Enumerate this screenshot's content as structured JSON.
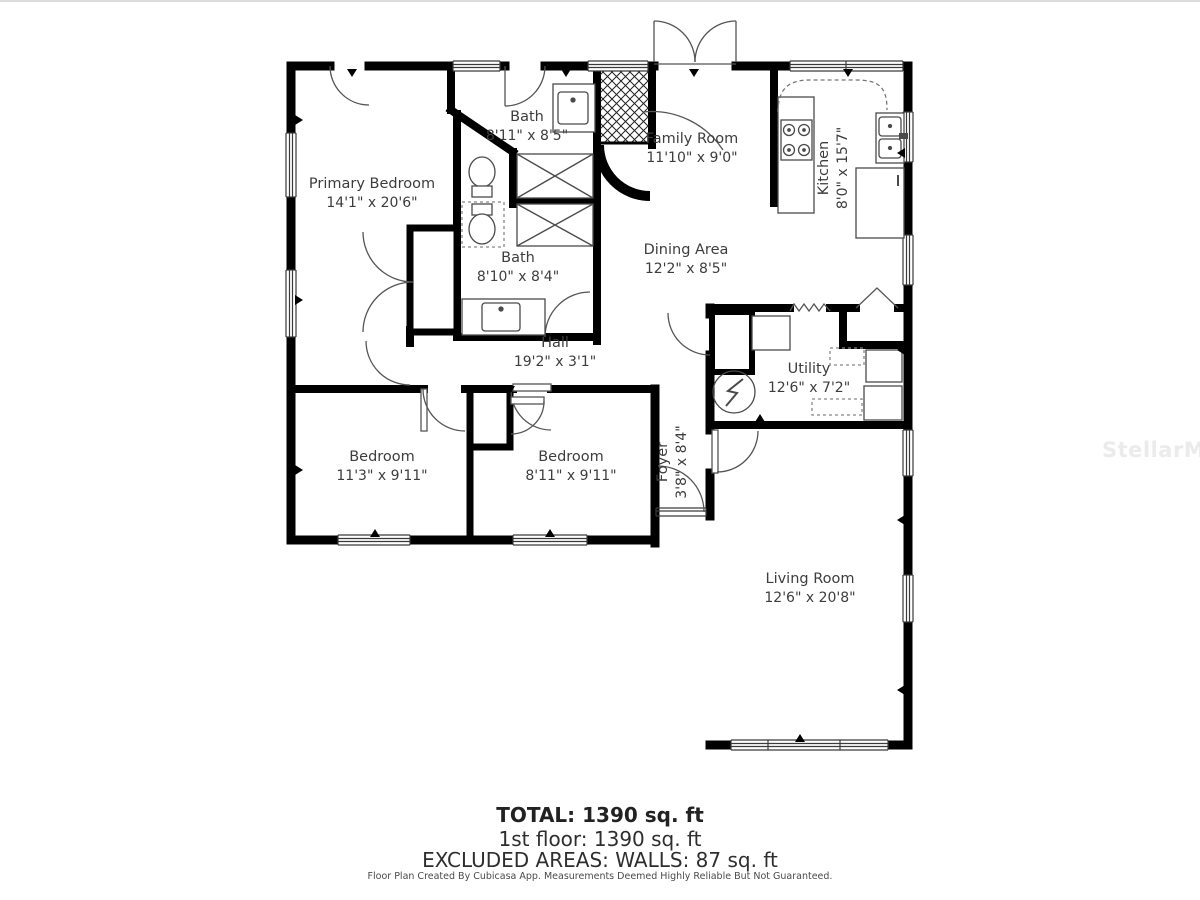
{
  "floor_plan": {
    "rooms": [
      {
        "id": "primary-bedroom",
        "name": "Primary Bedroom",
        "dims": "14'1\" x 20'6\""
      },
      {
        "id": "bath-1",
        "name": "Bath",
        "dims": "8'11\" x 8'5\""
      },
      {
        "id": "family-room",
        "name": "Family Room",
        "dims": "11'10\" x 9'0\""
      },
      {
        "id": "kitchen",
        "name": "Kitchen",
        "dims": "8'0\" x 15'7\""
      },
      {
        "id": "dining-area",
        "name": "Dining Area",
        "dims": "12'2\" x 8'5\""
      },
      {
        "id": "bath-2",
        "name": "Bath",
        "dims": "8'10\" x 8'4\""
      },
      {
        "id": "hall",
        "name": "Hall",
        "dims": "19'2\" x 3'1\""
      },
      {
        "id": "utility",
        "name": "Utility",
        "dims": "12'6\" x 7'2\""
      },
      {
        "id": "bedroom-1",
        "name": "Bedroom",
        "dims": "11'3\" x 9'11\""
      },
      {
        "id": "bedroom-2",
        "name": "Bedroom",
        "dims": "8'11\" x 9'11\""
      },
      {
        "id": "foyer",
        "name": "Foyer",
        "dims": "3'8\" x 8'4\""
      },
      {
        "id": "living-room",
        "name": "Living Room",
        "dims": "12'6\" x 20'8\""
      }
    ],
    "summary": {
      "total": "TOTAL: 1390 sq. ft",
      "floor1": "1st floor: 1390 sq. ft",
      "excluded": "EXCLUDED AREAS: WALLS: 87 sq. ft"
    },
    "credit": "Floor Plan Created By Cubicasa App. Measurements Deemed Highly Reliable But Not Guaranteed.",
    "watermark": "StellarMLS",
    "colors": {
      "wall": "#000000",
      "label": "#3d3d3d",
      "watermark": "#ebebeb"
    }
  }
}
